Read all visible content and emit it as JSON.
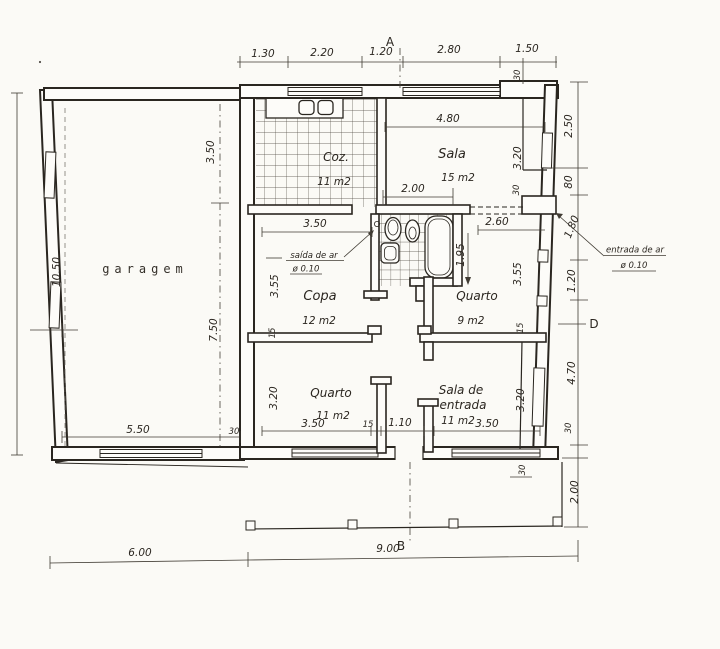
{
  "drawing": {
    "markers": {
      "a": "A",
      "b": "B",
      "d": "D"
    },
    "rooms": {
      "garagem": {
        "name": "garagem"
      },
      "coz": {
        "name": "Coz.",
        "area": "11 m2"
      },
      "sala": {
        "name": "Sala",
        "area": "15 m2"
      },
      "copa": {
        "name": "Copa",
        "area": "12 m2"
      },
      "quarto9": {
        "name": "Quarto",
        "area": "9 m2"
      },
      "quarto11": {
        "name": "Quarto",
        "area": "11 m2"
      },
      "sala_entrada": {
        "line1": "Sala de",
        "line2": "entrada",
        "area": "11 m2"
      }
    },
    "annotations": {
      "saida": {
        "label": "saída de ar",
        "dia": "ø 0.10"
      },
      "entrada": {
        "label": "entrada de ar",
        "dia": "ø 0.10"
      }
    },
    "dims": {
      "top": {
        "d1": "1.30",
        "d2": "2.20",
        "d3": "1.20",
        "d4": "2.80",
        "d5": "1.50",
        "wall": "30"
      },
      "right": {
        "d1": "2.50",
        "d2": "80",
        "d3": "1.80",
        "d4": "1.20",
        "d5": "4.70",
        "d6": "30",
        "d7": "2.00"
      },
      "bottom": {
        "d1": "6.00",
        "d2": "9.00"
      },
      "left": {
        "d1": "10.50"
      },
      "garage": {
        "v1": "3.50",
        "v2": "7.50",
        "w": "5.50",
        "wall": "30"
      },
      "sala": {
        "w": "4.80",
        "open": "2.00",
        "h": "3.20",
        "wall": "30"
      },
      "copa": {
        "w": "3.50",
        "h": "3.55",
        "wall": "15"
      },
      "quarto9": {
        "top": "2.60",
        "bath": "1.95",
        "h": "3.55",
        "wall": "15"
      },
      "quarto11": {
        "w": "3.50",
        "wall": "15",
        "hall": "1.10",
        "h": "3.20"
      },
      "sala_entrada": {
        "w": "3.50",
        "h": "3.20"
      },
      "porch": {
        "wall": "30"
      }
    }
  }
}
